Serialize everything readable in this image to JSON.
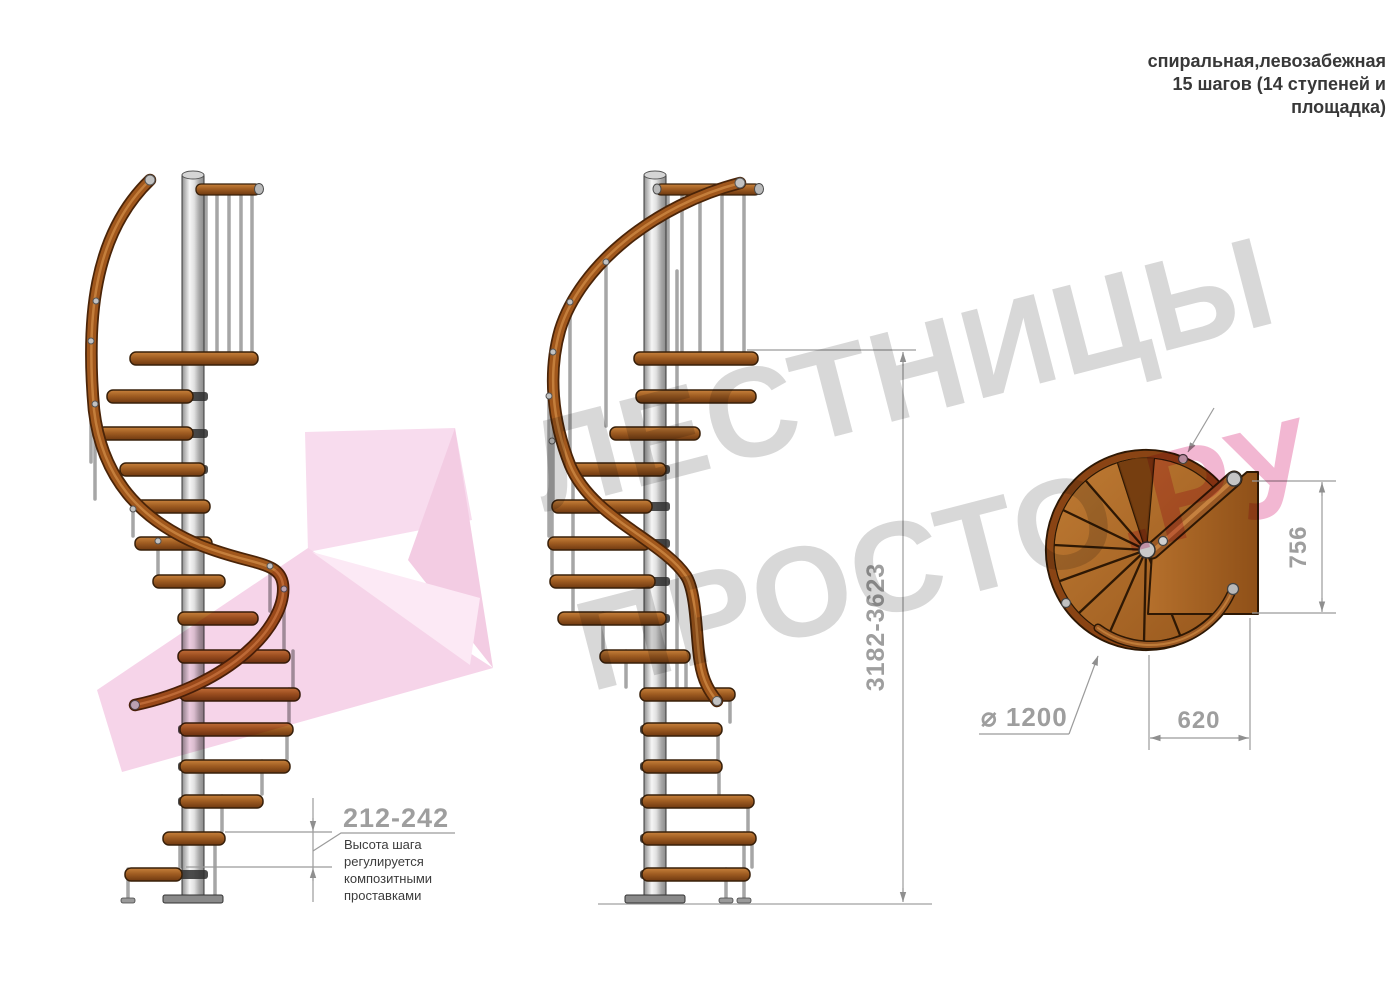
{
  "title": {
    "line1": "спиральная,левозабежная",
    "line2": "15 шагов (14 ступеней и",
    "line3": "площадка)"
  },
  "watermark": {
    "word1": "ЛЕСТНИЦЫ",
    "word2": "ПРОСТО",
    "suffix": ".РУ"
  },
  "dimensions": {
    "total_height": "3182-3623",
    "step_height": "212-242",
    "step_height_note": [
      "Высота шага",
      "регулируется",
      "композитными",
      "проставками"
    ],
    "platform_depth": "756",
    "platform_width": "620",
    "diameter": "⌀ 1200"
  },
  "colors": {
    "wood": "#a05d22",
    "wood_dark": "#38200a",
    "rail_wood": "#9c5a24",
    "pole_gray": "#c9c9c9",
    "dimension_gray": "#9e9e9e",
    "note_text": "#3c3c3c",
    "watermark_gray": "#d8d8d8",
    "watermark_pink": "#f2b7d2",
    "arrow_pink": "#f6d4e9"
  }
}
